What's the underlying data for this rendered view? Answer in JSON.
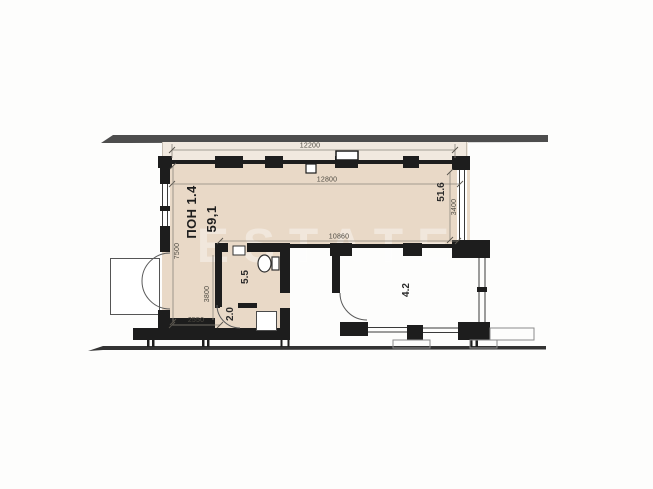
{
  "watermark": "ESTATE",
  "plan": {
    "unit": {
      "label": "ПОН 1.4",
      "area": "59,1"
    },
    "areas": {
      "hall": "51.6",
      "bathroom": "5.5",
      "entry": "2.0",
      "balcony_room": "4.2"
    },
    "dims": {
      "top": "12200",
      "width_upper": "12800",
      "width_lower": "10860",
      "height_right": "3400",
      "height_left": "7500",
      "height_bath": "3800",
      "width_bottom": "2550"
    }
  }
}
